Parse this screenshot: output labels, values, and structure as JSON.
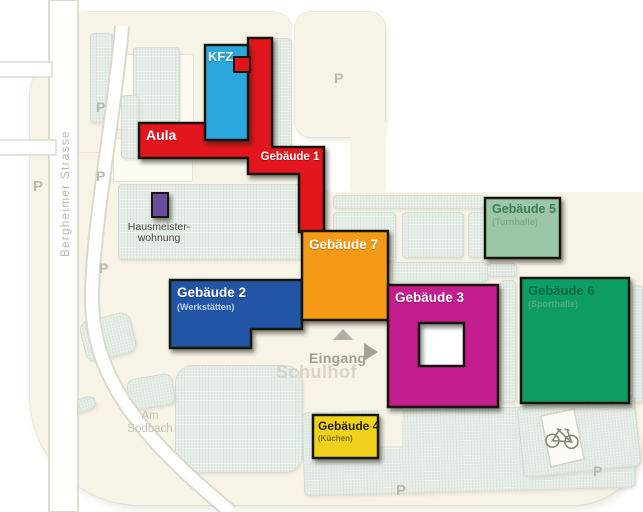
{
  "map": {
    "streets": {
      "bergheimer_strasse": "Bergheimer Strasse",
      "am_sodbach_line1": "Am",
      "am_sodbach_line2": "Sodbach"
    },
    "labels": {
      "eingang": "Eingang",
      "schulhof": "Schulhof",
      "parking": "P"
    },
    "icons": {
      "bicycle": "bicycle-parking",
      "entrance_arrow": "arrow-right",
      "north_arrow": "arrow-up"
    },
    "colors": {
      "ground_cream": "#f8f3e7",
      "ground_mint": "#e4ece5",
      "road_white": "#ffffff",
      "outline_black": "#17170f"
    },
    "buildings": [
      {
        "id": "aula",
        "label": "Aula",
        "color": "#e2121b"
      },
      {
        "id": "kfz",
        "label": "KFZ",
        "color": "#2ba7dd"
      },
      {
        "id": "gebaeude-1",
        "label": "Gebäude 1",
        "color": "#e2121b"
      },
      {
        "id": "gebaeude-2",
        "label": "Gebäude 2",
        "sublabel": "(Werkstätten)",
        "color": "#2254a5"
      },
      {
        "id": "gebaeude-3",
        "label": "Gebäude 3",
        "color": "#c21a8e"
      },
      {
        "id": "gebaeude-4",
        "label": "Gebäude 4",
        "sublabel": "(Küchen)",
        "color": "#f0d11d"
      },
      {
        "id": "gebaeude-5",
        "label": "Gebäude 5",
        "sublabel": "(Turnhalle)",
        "color": "#9cc7a6"
      },
      {
        "id": "gebaeude-6",
        "label": "Gebäude 6",
        "sublabel": "(Sporthalle)",
        "color": "#0e9c63"
      },
      {
        "id": "gebaeude-7",
        "label": "Gebäude 7",
        "color": "#f49a16"
      },
      {
        "id": "hausmeisterwohnung",
        "label_line1": "Hausmeister-",
        "label_line2": "wohnung",
        "color": "#6a4b9e"
      }
    ]
  }
}
